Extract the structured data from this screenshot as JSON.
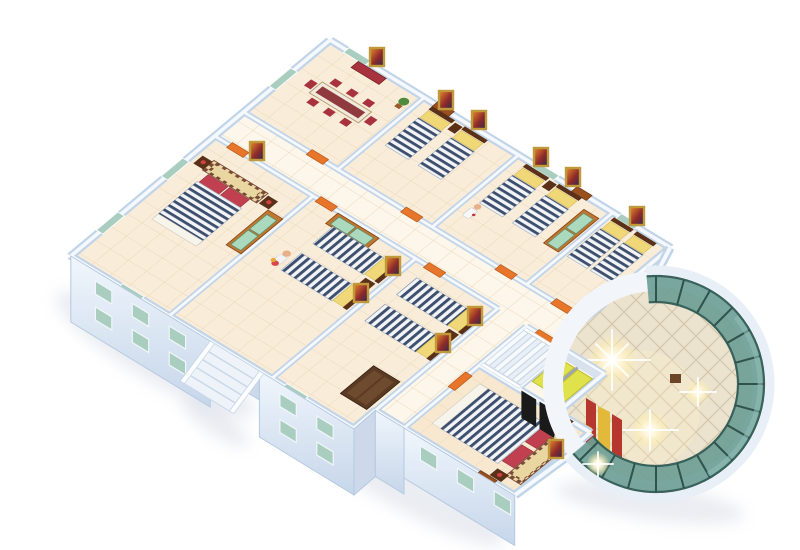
{
  "scene": {
    "description": "3D isometric cutaway rendering of a hotel dormitory floor plan on a white background",
    "view": "axonometric dollhouse cutaway, viewed from above south-west",
    "background": "#ffffff"
  },
  "palette": {
    "floor-tile": "#f9ecd9",
    "floor-light": "#fdf6ea",
    "floor-warm": "#f8e8cf",
    "tile-line": "#ecd8bc",
    "wall-base": "#c2d4e8",
    "wall-top": "#f5f9fe",
    "facade-shade": "#cdd9ea",
    "window-glass": "#a9cdbf",
    "door-orange": "#e8762a",
    "door-brown": "#9a4f1e",
    "wood": "#c07830",
    "wood-dark": "#8a4a18",
    "wardrobe-panel": "#abd9bd",
    "mattress-base": "#f2f4f7",
    "mattress-stripe": "#3e4f6e",
    "pillow-yellow": "#f0d878",
    "pillow-red": "#c04050",
    "headboard-tan": "#e9d6a0",
    "checker-brown": "#7a4a38",
    "furn-dark": "#5a3018",
    "chair-red": "#a8333e",
    "table-top": "#f0e9dc",
    "elevator-car": "#dfe24a",
    "shaft-black": "#1a1a1a",
    "atrium-marble": "#ece3cf",
    "marble-line": "#d2c7ae",
    "glass-teal": "#6e9e96",
    "glass-edge": "#38625b",
    "glass-mullion": "#2f524c",
    "glass-highlight": "#8fbcb4",
    "rim-white": "#e9eff7",
    "walkway-white": "#f2f6fb",
    "counter-red": "#b5372e",
    "counter-yellow": "#e3b93c",
    "gold-frame": "#c09a3a",
    "shadow": "#b8c4d4",
    "stair-tread": "#f7fafc",
    "stair-tread-alt": "#e9eff6",
    "stair-edge": "#c9d6e6",
    "skin": "#e8b088"
  },
  "building": {
    "rooms": [
      {
        "id": "meeting-room",
        "type": "meeting room",
        "furniture": [
          "long table",
          "6 red chairs",
          "sideboard",
          "plant",
          "wall painting"
        ]
      },
      {
        "id": "bedroom-north-1",
        "type": "twin bedroom",
        "furniture": [
          "2 striped twin beds",
          "yellow pillows",
          "nightstand",
          "wall paintings"
        ]
      },
      {
        "id": "bedroom-north-2",
        "type": "twin bedroom",
        "furniture": [
          "2 striped twin beds",
          "nightstand",
          "wardrobe with green doors",
          "wall paintings",
          "standing figure"
        ]
      },
      {
        "id": "bedroom-north-3",
        "type": "twin bedroom",
        "furniture": [
          "2 striped twin beds",
          "wall painting"
        ]
      },
      {
        "id": "master-bedroom-west",
        "type": "double bedroom",
        "furniture": [
          "double bed with checkered headboard frame",
          "red pillows",
          "2 nightstands with lamps",
          "wardrobe",
          "wall painting"
        ]
      },
      {
        "id": "bedroom-west-2",
        "type": "twin bedroom",
        "furniture": [
          "2 striped twin beds",
          "nightstand",
          "wardrobe",
          "figure holding flowers",
          "wall paintings"
        ]
      },
      {
        "id": "bedroom-south",
        "type": "twin bedroom",
        "furniture": [
          "2 striped twin beds",
          "nightstand",
          "tall dark wardrobe",
          "wall paintings"
        ]
      },
      {
        "id": "master-bedroom-south",
        "type": "double bedroom",
        "furniture": [
          "double bed with checkered headboard frame",
          "red pillows",
          "2 nightstands",
          "wall painting"
        ]
      }
    ],
    "circulation": {
      "corridor": "L-shaped corridor lined with orange doors",
      "staircase": "interior staircase beside elevator bank",
      "elevators": 2,
      "entrance_ramp": "exterior stepped ramp with white railings on the south-west facade"
    },
    "facade": {
      "walls": "white-blue exterior walls",
      "windows": "teal glass windows in two rows on the west wing and one row under the south master bedroom"
    },
    "atrium": {
      "shape": "circular glass rotunda",
      "glass": "curved teal curtain wall with dark mullions and white outer rim",
      "floor": "polished marble with diagonal grid and bright light flares",
      "features": [
        "red and yellow reception counters",
        "white curved walkway",
        "small brown planter box"
      ]
    }
  }
}
